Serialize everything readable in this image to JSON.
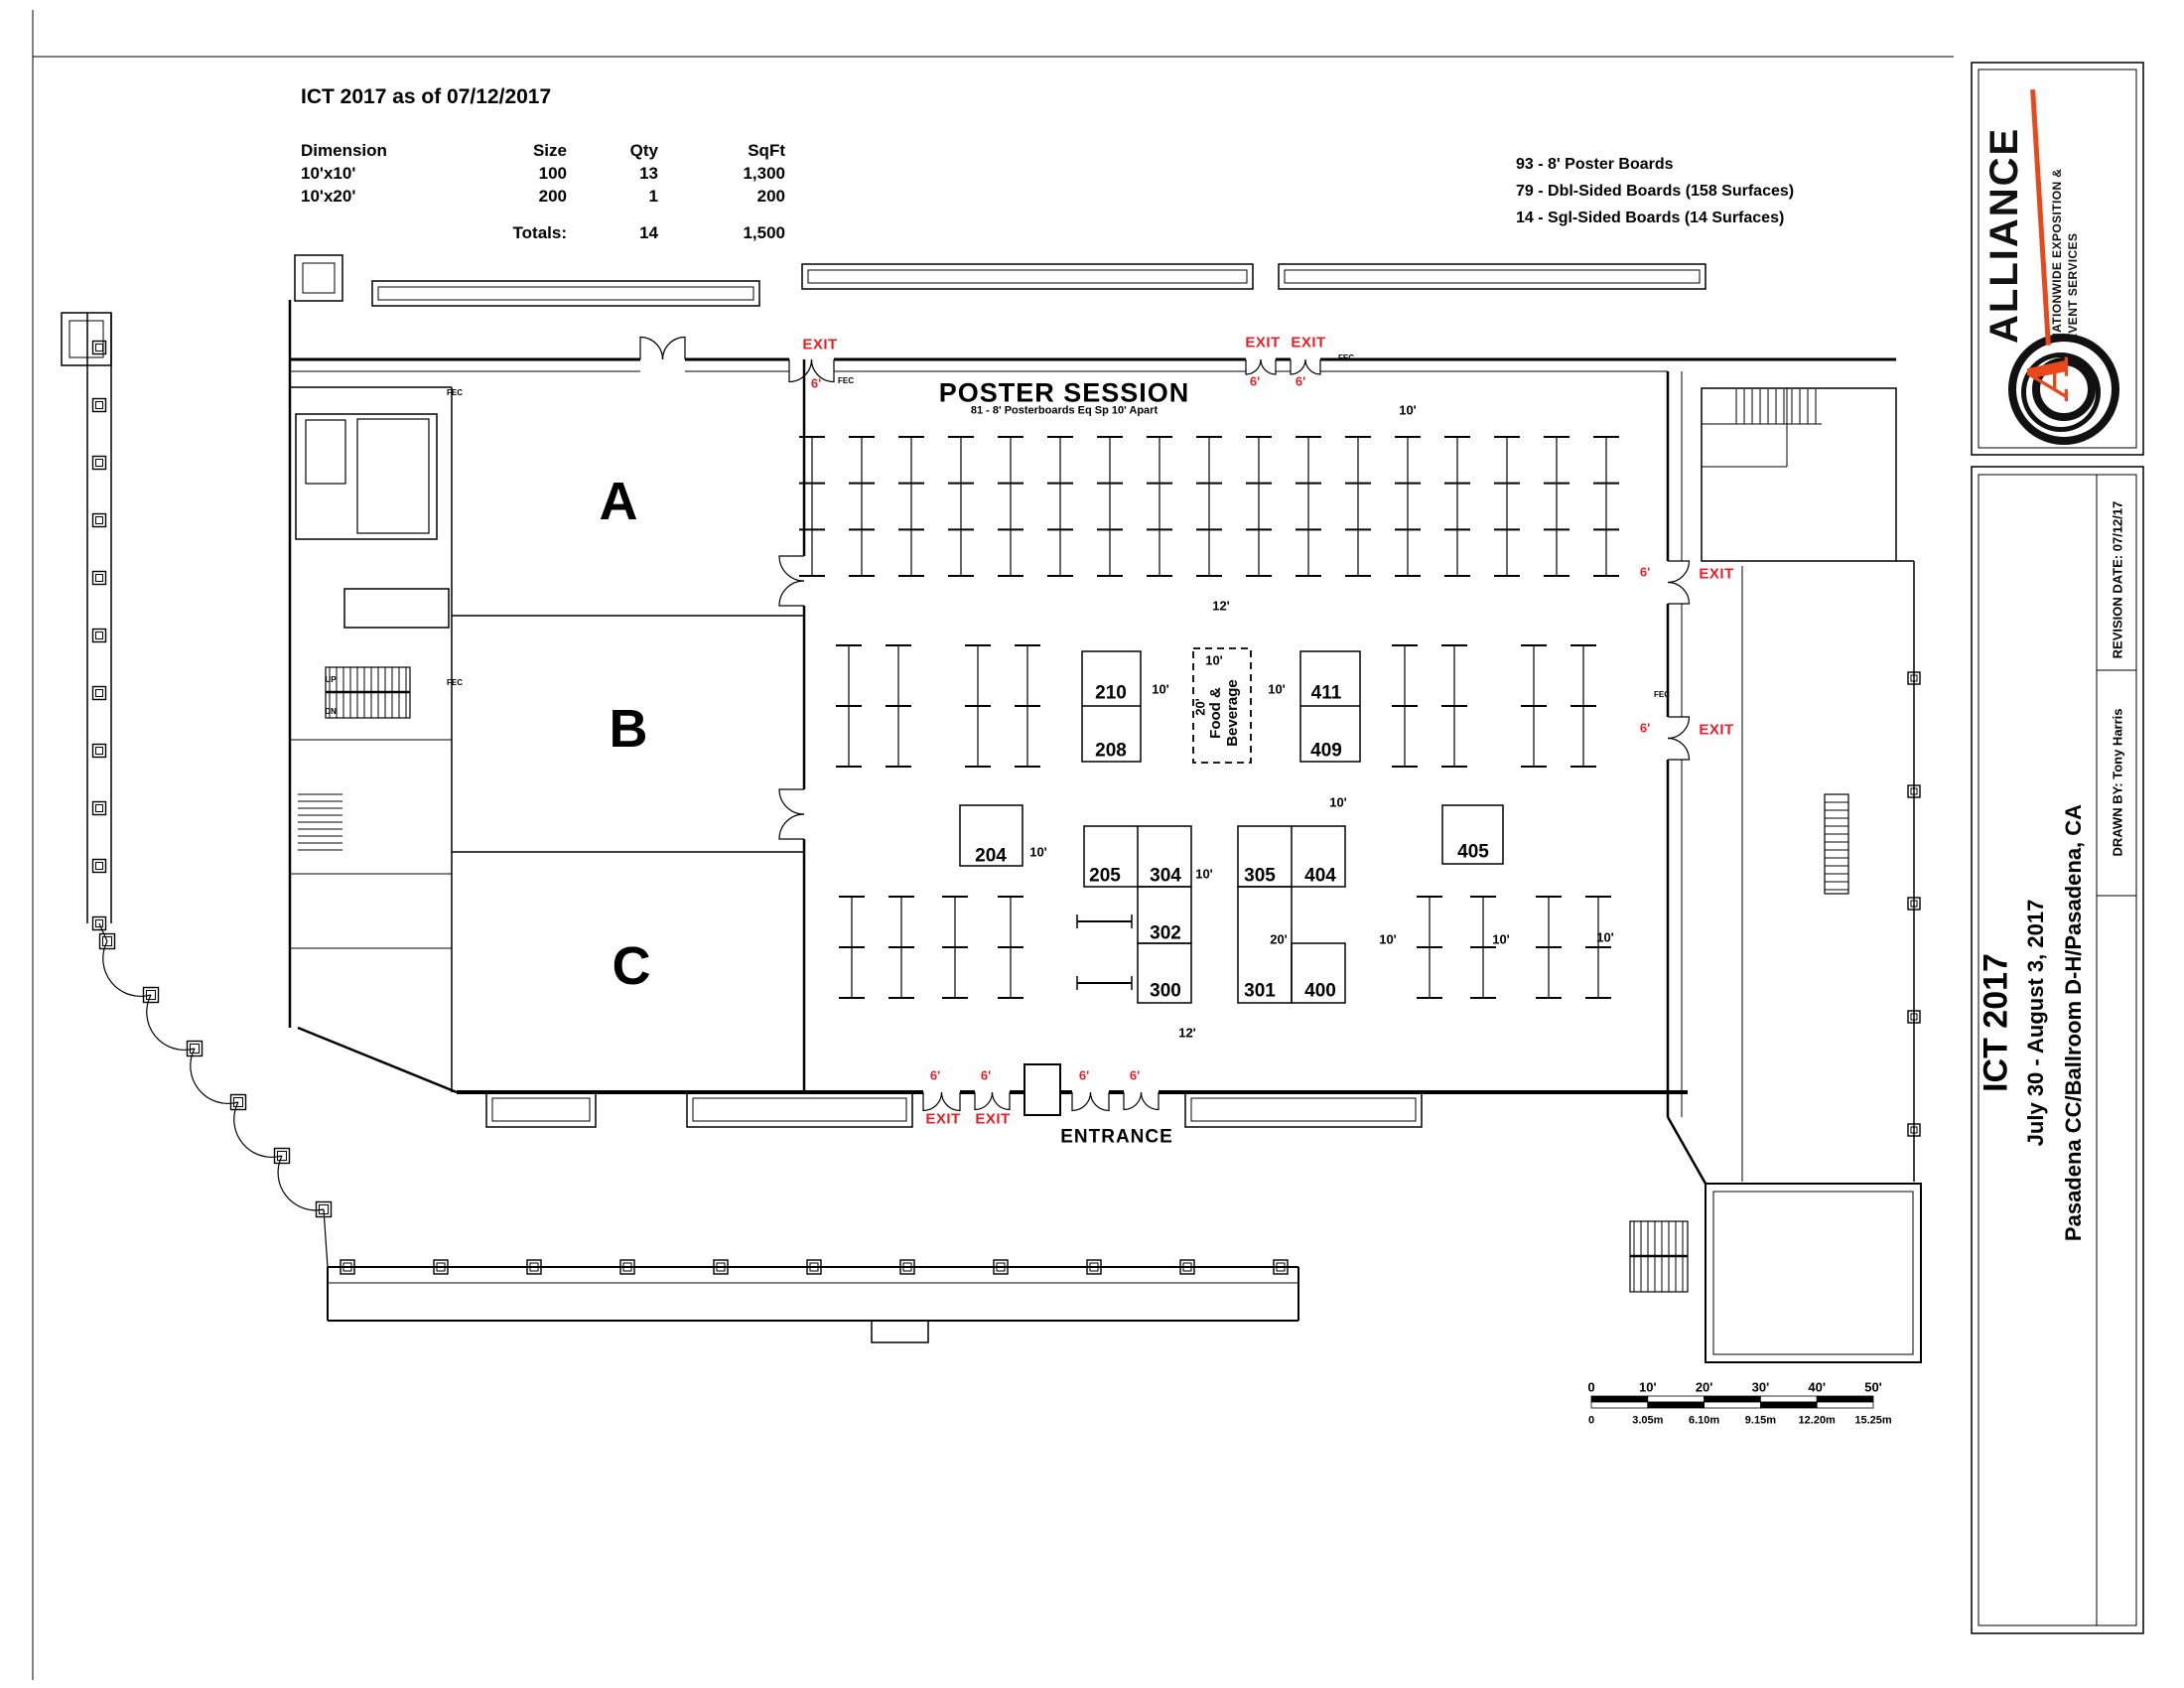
{
  "header": {
    "plan_status_title": "ICT 2017 as of 07/12/2017",
    "table": {
      "headers": [
        "Dimension",
        "Size",
        "Qty",
        "SqFt"
      ],
      "rows": [
        [
          "10'x10'",
          "100",
          "13",
          "1,300"
        ],
        [
          "10'x20'",
          "200",
          "1",
          "200"
        ]
      ],
      "totals": [
        "",
        "Totals:",
        "14",
        "1,500"
      ]
    },
    "notes": [
      "93 - 8' Poster Boards",
      "79 - Dbl-Sided Boards (158 Surfaces)",
      "14 - Sgl-Sided Boards (14 Surfaces)"
    ]
  },
  "plan": {
    "poster_session": {
      "title": "POSTER SESSION",
      "subtitle": "81 - 8' Posterboards Eq Sp 10' Apart"
    },
    "rooms": {
      "a": "A",
      "b": "B",
      "c": "C"
    },
    "booths": {
      "b210": "210",
      "b208": "208",
      "b204": "204",
      "b205": "205",
      "b304": "304",
      "b302": "302",
      "b300": "300",
      "b301": "301",
      "b305": "305",
      "b404": "404",
      "b400": "400",
      "b405": "405",
      "b411": "411",
      "b409": "409"
    },
    "food_beverage": "Food & Beverage",
    "labels": {
      "exit": "EXIT",
      "entrance": "ENTRANCE",
      "fec": "FEC",
      "up": "UP",
      "dn": "DN",
      "d6": "6'",
      "d10": "10'",
      "d12": "12'",
      "d20": "20'"
    }
  },
  "scale_bar": {
    "feet": [
      "0",
      "10'",
      "20'",
      "30'",
      "40'",
      "50'"
    ],
    "meters": [
      "0",
      "3.05m",
      "6.10m",
      "9.15m",
      "12.20m",
      "15.25m"
    ]
  },
  "sidebar": {
    "logo": {
      "brand": "ALLIANCE",
      "monogram": "A",
      "tagline_line1": "NATIONWIDE EXPOSITION &",
      "tagline_line2": "EVENT SERVICES"
    },
    "title_block": {
      "event": "ICT 2017",
      "dates": "July 30 - August 3, 2017",
      "venue": "Pasadena CC/Ballroom D-H/Pasadena, CA",
      "drawn_by": "DRAWN BY: Tony Harris",
      "revision_date": "REVISION DATE: 07/12/17"
    }
  },
  "colors": {
    "exit_red": "#ed1c24",
    "logo_red": "#e8481c",
    "ink": "#000000"
  }
}
